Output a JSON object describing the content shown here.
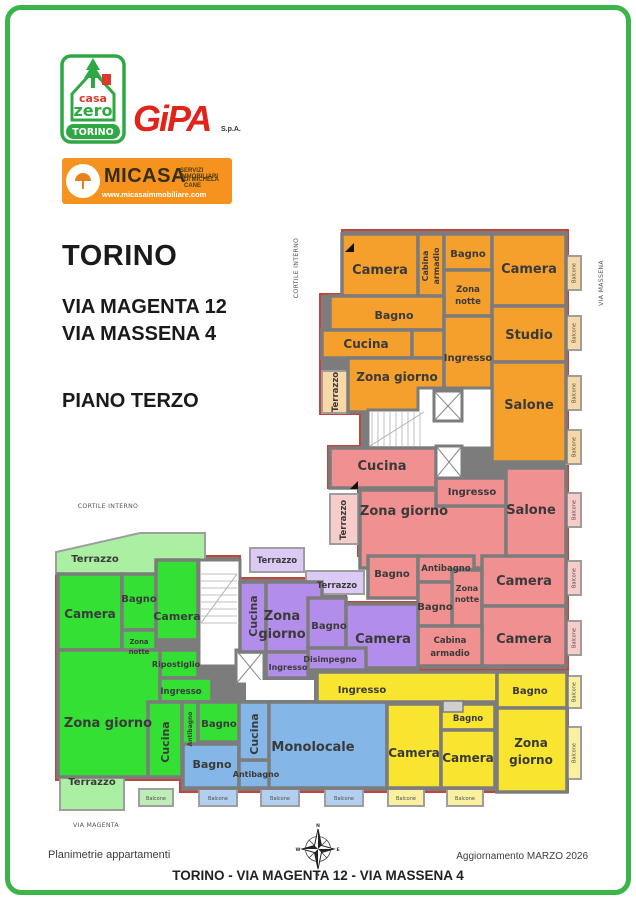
{
  "page": {
    "footer_left": "Planimetrie appartamenti",
    "footer_right": "Aggiornamento MARZO 2026",
    "footer_title": "TORINO - VIA MAGENTA 12 - VIA MASSENA 4"
  },
  "logos": {
    "casazero": {
      "casa": "casa",
      "zero": "zero",
      "torino": "TORINO"
    },
    "gipa": {
      "name": "GiPA",
      "spa": "S.p.A."
    },
    "micasa": {
      "name": "MICASA",
      "line1": "SERVIZI IMMOBILIARI",
      "line2": "DI MICHELA CANE",
      "url": "www.micasaimmobiliare.com"
    }
  },
  "heading": {
    "city": "TORINO",
    "address1": "VIA MAGENTA 12",
    "address2": "VIA MASSENA 4",
    "floor": "PIANO TERZO"
  },
  "area_labels": {
    "cortile_top": "CORTILE INTERNO",
    "cortile_left": "CORTILE INTERNO",
    "via_massena": "VIA MASSENA",
    "via_magenta": "VIA MAGENTA"
  },
  "room_labels": {
    "camera": "Camera",
    "bagno": "Bagno",
    "antibagno": "Antibagno",
    "cucina": "Cucina",
    "salone": "Salone",
    "studio": "Studio",
    "ingresso": "Ingresso",
    "terrazzo": "Terrazzo",
    "balcone": "Balcone",
    "monolocale": "Monolocale",
    "ripostiglio": "Ripostiglio",
    "disimpegno": "Disimpegno",
    "zona": "Zona",
    "notte": "notte",
    "giorno": "giorno",
    "zona_giorno": "Zona giorno",
    "cabina": "Cabina",
    "armadio": "armadio"
  },
  "compass": {
    "n": "N",
    "e": "E",
    "s": "S",
    "w": "W"
  },
  "colors": {
    "accent_green": "#3bb54a",
    "orange": "#f5a02c",
    "pink": "#f19090",
    "green": "#35e035",
    "purple": "#b28de9",
    "blue": "#84b6e8",
    "yellow": "#f9e42f",
    "wall": "#7c7c7c",
    "exterior_line": "#c2453c",
    "micasa_orange": "#f6921e",
    "gipa_red": "#e2231a"
  }
}
